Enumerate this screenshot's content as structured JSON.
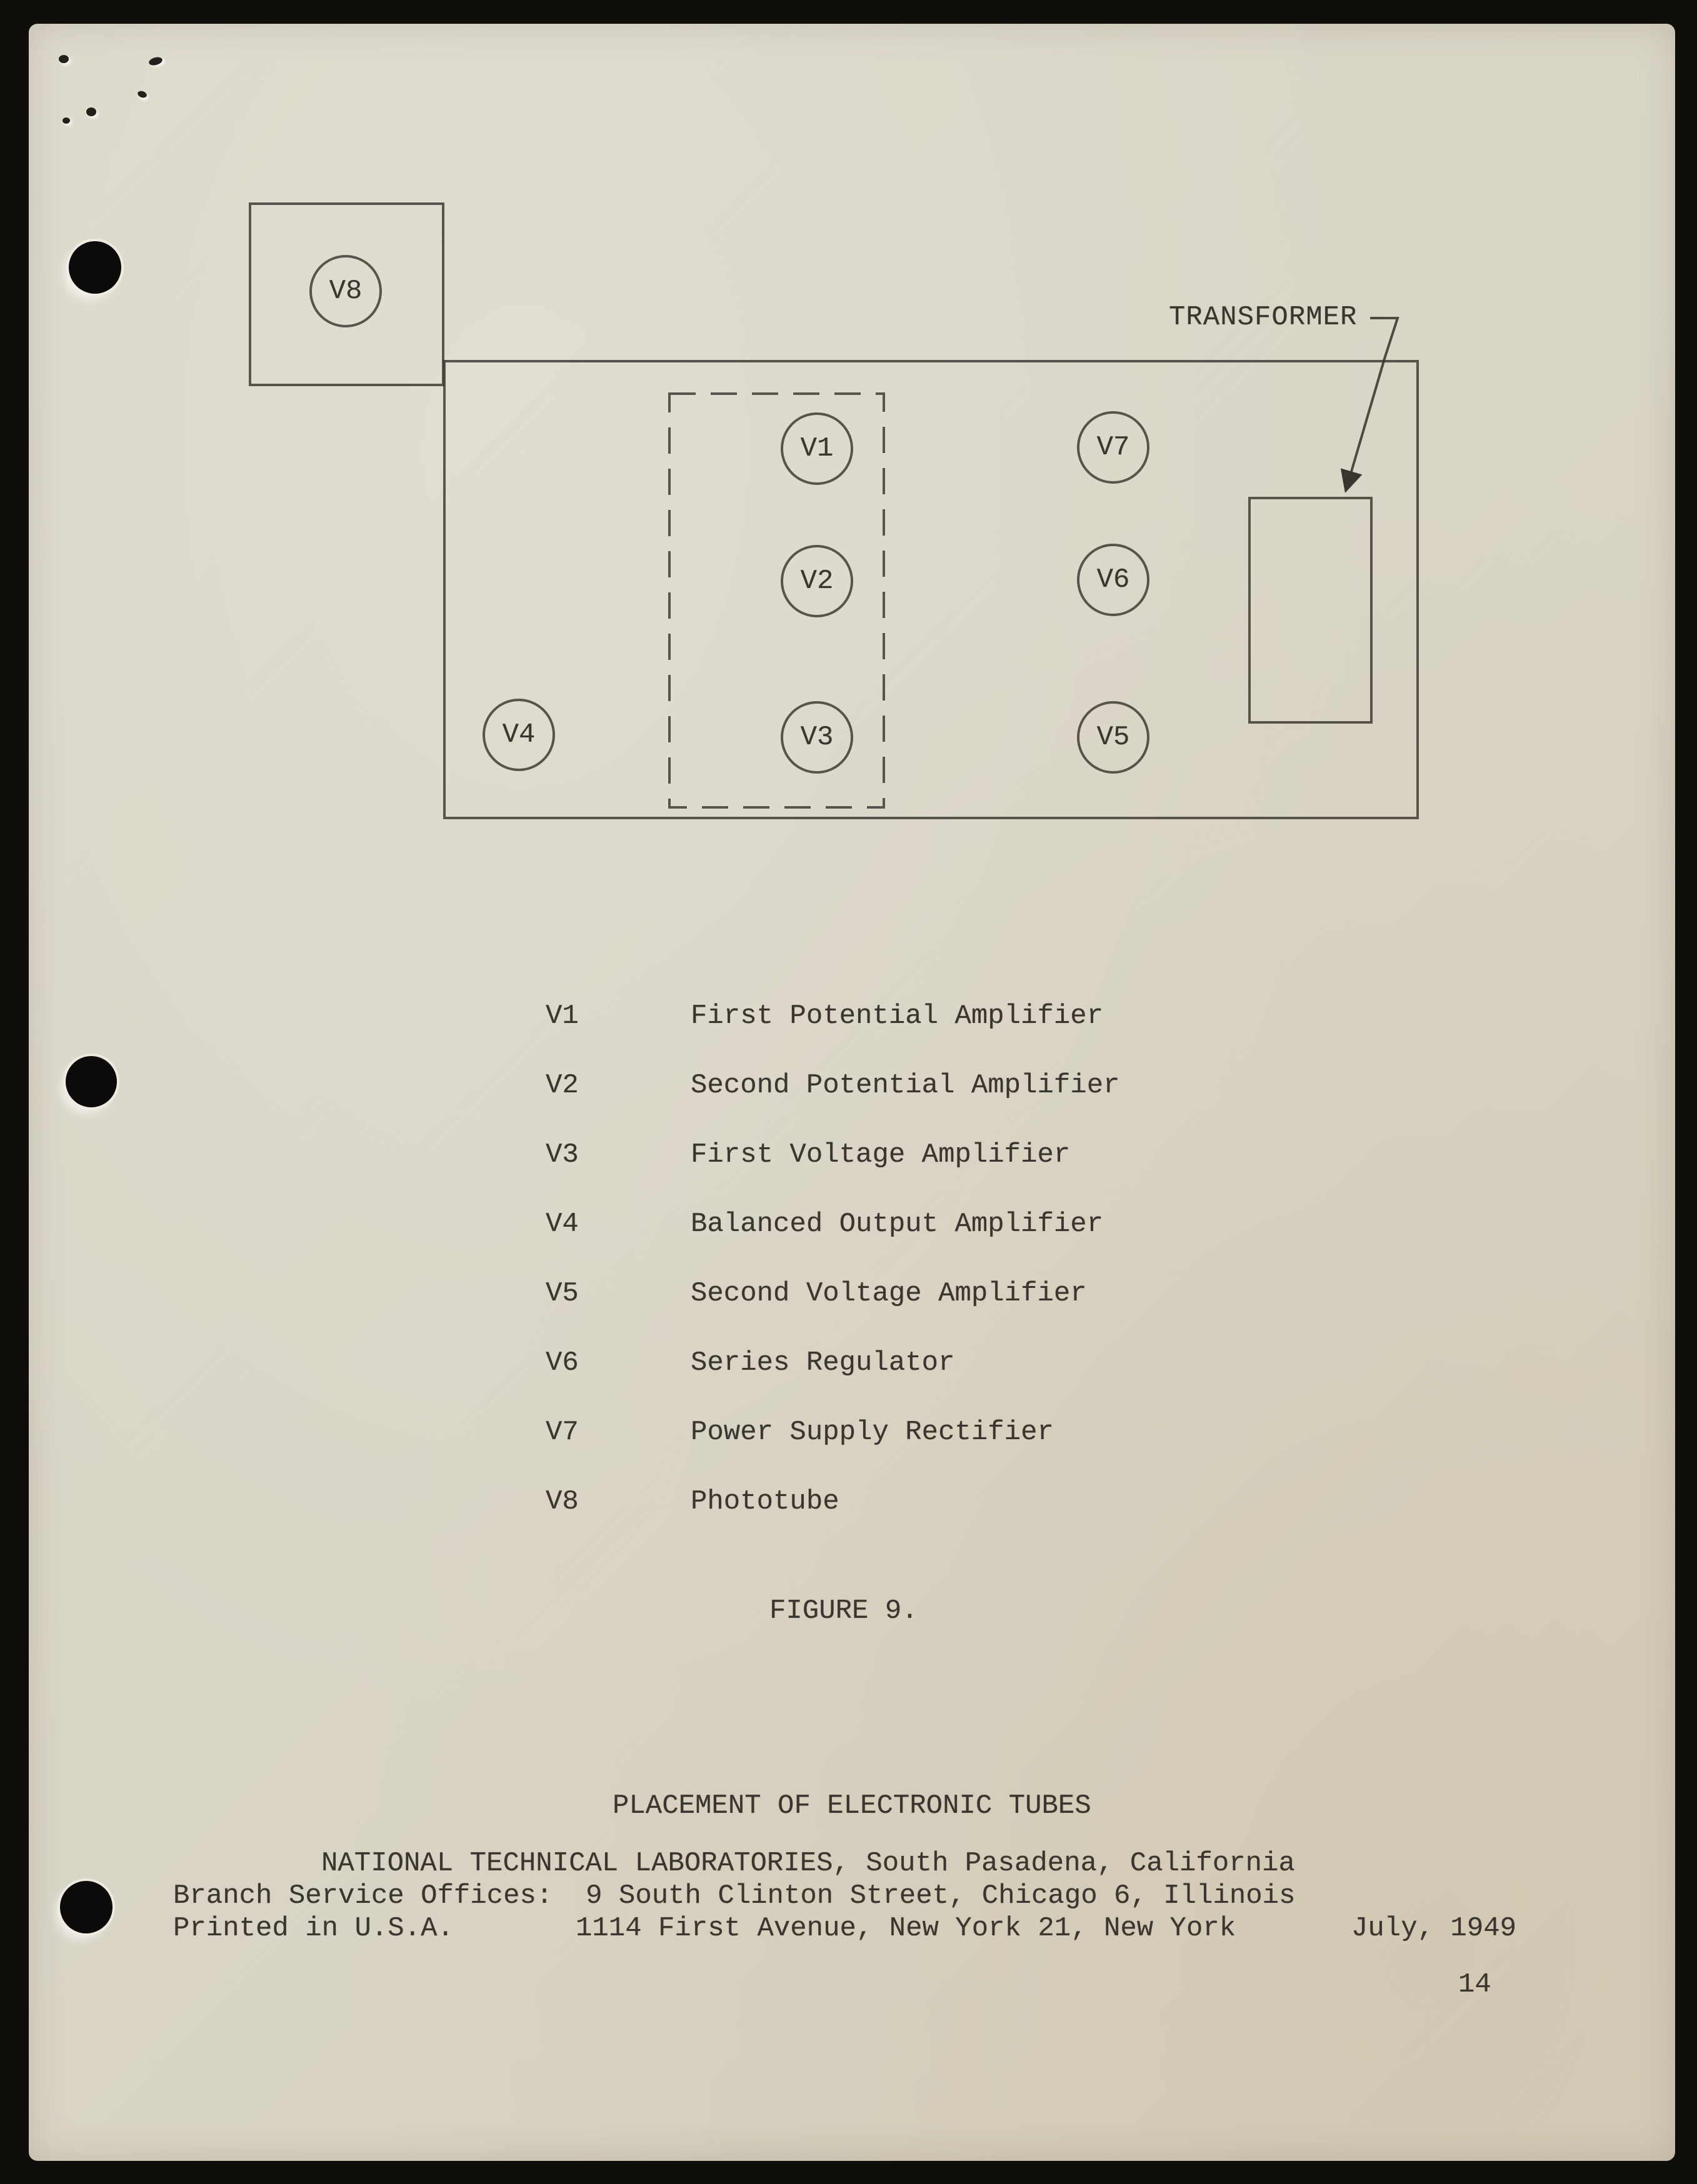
{
  "colors": {
    "scan_background": "#0f0e0b",
    "paper": "#d9d5c7",
    "ink": "#3a362f"
  },
  "diagram": {
    "transformer_label": "TRANSFORMER",
    "tubes": {
      "v1": "V1",
      "v2": "V2",
      "v3": "V3",
      "v4": "V4",
      "v5": "V5",
      "v6": "V6",
      "v7": "V7",
      "v8": "V8"
    }
  },
  "legend": {
    "items": [
      {
        "id": "V1",
        "desc": "First Potential Amplifier"
      },
      {
        "id": "V2",
        "desc": "Second Potential Amplifier"
      },
      {
        "id": "V3",
        "desc": "First Voltage Amplifier"
      },
      {
        "id": "V4",
        "desc": "Balanced Output Amplifier"
      },
      {
        "id": "V5",
        "desc": "Second Voltage Amplifier"
      },
      {
        "id": "V6",
        "desc": "Series Regulator"
      },
      {
        "id": "V7",
        "desc": "Power Supply Rectifier"
      },
      {
        "id": "V8",
        "desc": "Phototube"
      }
    ]
  },
  "captions": {
    "figure": "FIGURE 9.",
    "title": "PLACEMENT OF ELECTRONIC TUBES"
  },
  "footer": {
    "publisher": "NATIONAL TECHNICAL LABORATORIES, South Pasadena, California",
    "branch": "Branch Service Offices:  9 South Clinton Street, Chicago 6, Illinois",
    "printed": "Printed in U.S.A.",
    "address": "1114 First Avenue, New York 21, New York",
    "date": "July, 1949",
    "page_number": "14"
  }
}
